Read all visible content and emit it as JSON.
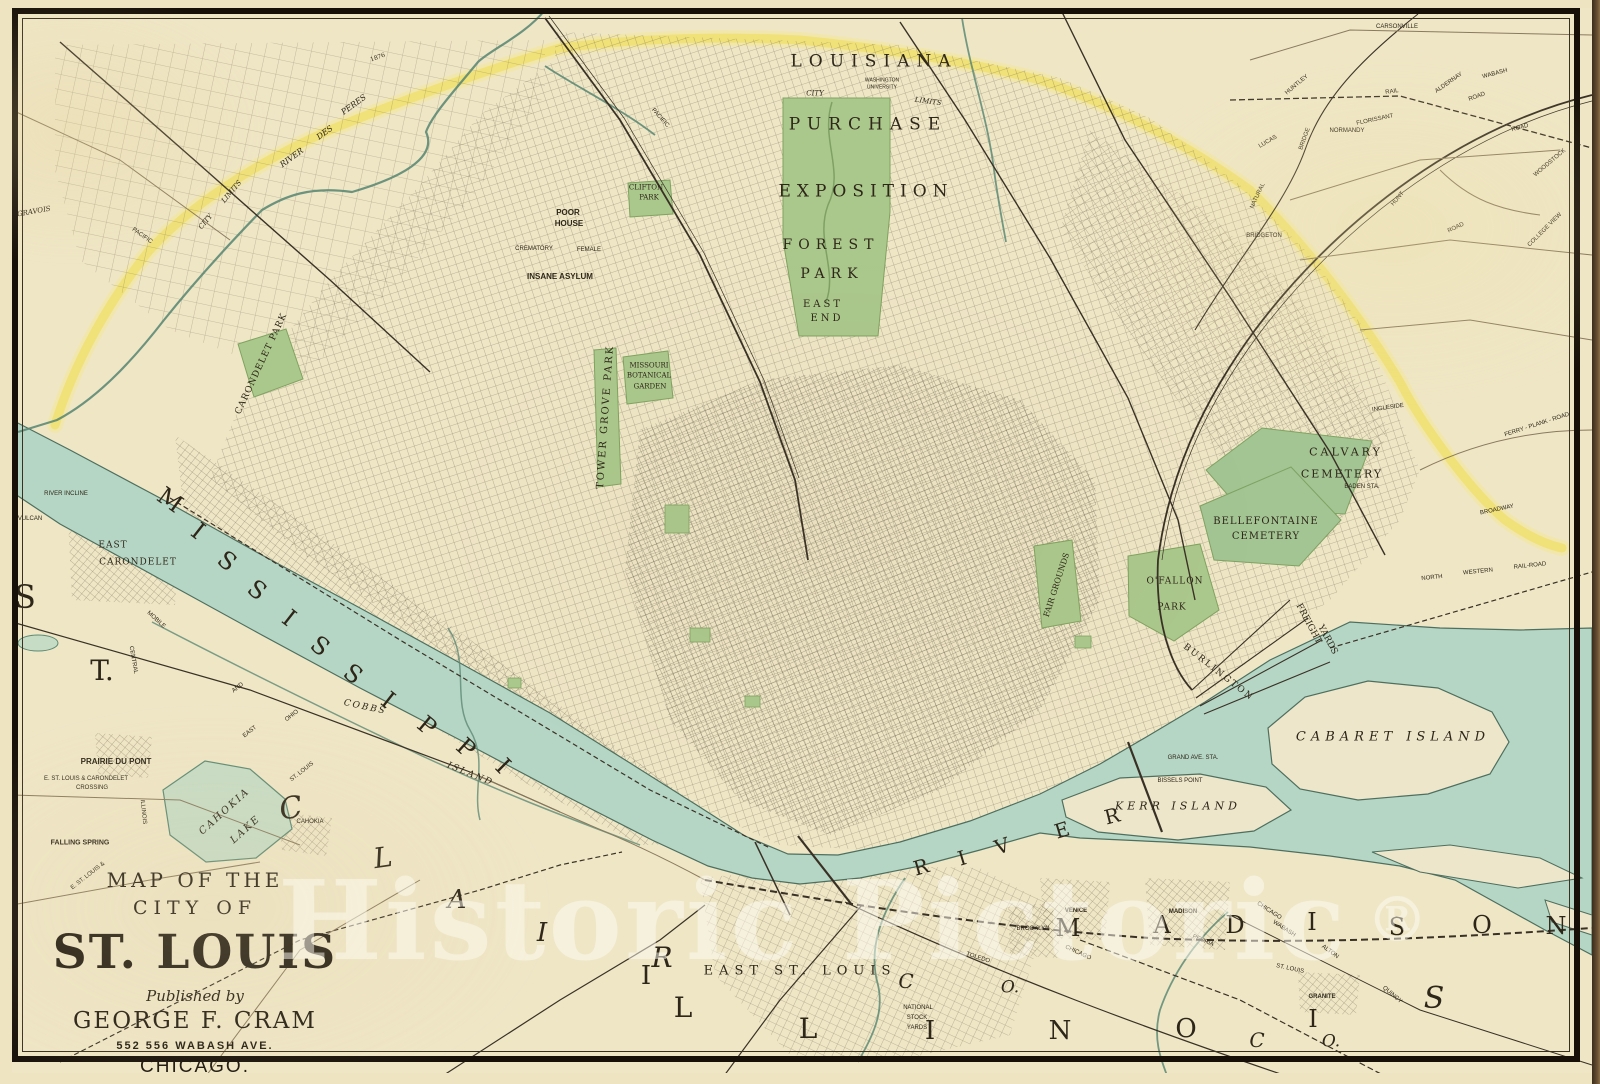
{
  "watermark": {
    "text": "Historic Pictoric",
    "registered": "®"
  },
  "title_block": {
    "line1": "MAP OF THE",
    "line2": "CITY OF",
    "line3": "ST. LOUIS",
    "line4": "Published by",
    "line5": "GEORGE F. CRAM",
    "line6": "552  556  WABASH AVE.",
    "line7": "CHICAGO."
  },
  "colors": {
    "paper": "#efe6c6",
    "water": "#b6d6c5",
    "water_edge": "#4d6f5f",
    "park_green": "#abc88c",
    "city_limit_yellow": "#f0e06b",
    "ink": "#2e2619",
    "frame": "#171009"
  },
  "labels": [
    {
      "t": "LOUISIANA",
      "x": 874,
      "y": 62,
      "s": 17,
      "ls": 7,
      "n": "label-louisiana"
    },
    {
      "t": "PURCHASE",
      "x": 868,
      "y": 125,
      "s": 17,
      "ls": 7,
      "n": "label-purchase"
    },
    {
      "t": "EXPOSITION",
      "x": 866,
      "y": 192,
      "s": 17,
      "ls": 6,
      "n": "label-exposition"
    },
    {
      "t": "FOREST",
      "x": 831,
      "y": 245,
      "s": 14,
      "ls": 6,
      "n": "label-forest-park"
    },
    {
      "t": "PARK",
      "x": 832,
      "y": 274,
      "s": 14,
      "ls": 6
    },
    {
      "t": "EAST",
      "x": 823,
      "y": 305,
      "s": 10,
      "ls": 3
    },
    {
      "t": "END",
      "x": 827,
      "y": 319,
      "s": 10,
      "ls": 3
    },
    {
      "t": "WASHINGTON",
      "x": 882,
      "y": 81,
      "s": 5,
      "f": "sans"
    },
    {
      "t": "UNIVERSITY",
      "x": 882,
      "y": 88,
      "s": 5,
      "f": "sans"
    },
    {
      "t": "CITY",
      "x": 815,
      "y": 94,
      "s": 7,
      "it": 1
    },
    {
      "t": "LIMITS",
      "x": 928,
      "y": 102,
      "s": 7,
      "it": 1,
      "r": 8
    },
    {
      "t": "CITY",
      "x": 206,
      "y": 222,
      "s": 7,
      "it": 1,
      "r": -50
    },
    {
      "t": "LIMITS",
      "x": 232,
      "y": 192,
      "s": 7,
      "it": 1,
      "r": -50
    },
    {
      "t": "1876",
      "x": 378,
      "y": 58,
      "s": 6,
      "r": -20
    },
    {
      "t": "RIVER",
      "x": 292,
      "y": 158,
      "s": 8,
      "it": 1,
      "r": -36
    },
    {
      "t": "DES",
      "x": 325,
      "y": 133,
      "s": 8,
      "it": 1,
      "r": -36
    },
    {
      "t": "PERES",
      "x": 354,
      "y": 105,
      "s": 8,
      "it": 1,
      "r": -36
    },
    {
      "t": "CLIFTON",
      "x": 646,
      "y": 188,
      "s": 7
    },
    {
      "t": "PARK",
      "x": 649,
      "y": 198,
      "s": 7
    },
    {
      "t": "POOR",
      "x": 568,
      "y": 213,
      "s": 8,
      "f": "sans",
      "b": 1
    },
    {
      "t": "HOUSE",
      "x": 569,
      "y": 224,
      "s": 8,
      "f": "sans",
      "b": 1
    },
    {
      "t": "CREMATORY",
      "x": 534,
      "y": 249,
      "s": 6,
      "f": "sans"
    },
    {
      "t": "FEMALE",
      "x": 589,
      "y": 250,
      "s": 6,
      "f": "sans"
    },
    {
      "t": "INSANE ASYLUM",
      "x": 560,
      "y": 277,
      "s": 8,
      "f": "sans",
      "b": 1,
      "n": "label-insane-asylum"
    },
    {
      "t": "CARONDELET PARK",
      "x": 262,
      "y": 364,
      "s": 9,
      "r": -65,
      "ls": 1,
      "n": "label-carondelet-park"
    },
    {
      "t": "TOWER GROVE PARK",
      "x": 606,
      "y": 417,
      "s": 10,
      "r": -86,
      "ls": 2,
      "n": "label-tower-grove-park"
    },
    {
      "t": "MISSOURI",
      "x": 649,
      "y": 366,
      "s": 7
    },
    {
      "t": "BOTANICAL",
      "x": 649,
      "y": 376,
      "s": 7
    },
    {
      "t": "GARDEN",
      "x": 650,
      "y": 387,
      "s": 7
    },
    {
      "t": "FAIR GROUNDS",
      "x": 1057,
      "y": 585,
      "s": 8,
      "r": -72,
      "n": "label-fair-grounds"
    },
    {
      "t": "O'FALLON",
      "x": 1175,
      "y": 582,
      "s": 9,
      "ls": 1,
      "n": "label-ofallon-park"
    },
    {
      "t": "PARK",
      "x": 1172,
      "y": 608,
      "s": 9,
      "ls": 1
    },
    {
      "t": "CALVARY",
      "x": 1346,
      "y": 452,
      "s": 11,
      "ls": 3,
      "n": "label-calvary-cemetery"
    },
    {
      "t": "CEMETERY",
      "x": 1342,
      "y": 474,
      "s": 11,
      "ls": 2
    },
    {
      "t": "BELLEFONTAINE",
      "x": 1266,
      "y": 522,
      "s": 10,
      "ls": 1,
      "n": "label-bellefontaine-cemetery"
    },
    {
      "t": "CEMETERY",
      "x": 1266,
      "y": 537,
      "s": 10,
      "ls": 1
    },
    {
      "t": "BURLINGTON",
      "x": 1218,
      "y": 673,
      "s": 9,
      "r": 38,
      "ls": 2
    },
    {
      "t": "FREIGHT",
      "x": 1308,
      "y": 624,
      "s": 9,
      "r": 62
    },
    {
      "t": "YARDS",
      "x": 1327,
      "y": 640,
      "s": 9,
      "r": 62
    },
    {
      "t": "GRAND AVE. STA.",
      "x": 1193,
      "y": 758,
      "s": 6,
      "f": "sans"
    },
    {
      "t": "BISSELS POINT",
      "x": 1180,
      "y": 781,
      "s": 6,
      "f": "sans"
    },
    {
      "t": "BADEN STA.",
      "x": 1362,
      "y": 487,
      "s": 6,
      "f": "sans"
    },
    {
      "t": "INGLESIDE",
      "x": 1388,
      "y": 408,
      "s": 6,
      "f": "sans",
      "r": -8
    },
    {
      "t": "NORTH",
      "x": 1432,
      "y": 578,
      "s": 6,
      "f": "sans",
      "r": -6
    },
    {
      "t": "WESTERN",
      "x": 1478,
      "y": 572,
      "s": 6,
      "f": "sans",
      "r": -6
    },
    {
      "t": "RAIL-ROAD",
      "x": 1530,
      "y": 566,
      "s": 6,
      "f": "sans",
      "r": -6
    },
    {
      "t": "BROADWAY",
      "x": 1497,
      "y": 510,
      "s": 6,
      "f": "sans",
      "r": -12
    },
    {
      "t": "FERRY - PLANK - ROAD",
      "x": 1537,
      "y": 425,
      "s": 6,
      "f": "sans",
      "r": -18
    },
    {
      "t": "RIVER INCLINE",
      "x": 66,
      "y": 494,
      "s": 6,
      "f": "sans"
    },
    {
      "t": "VULCAN",
      "x": 30,
      "y": 519,
      "s": 6,
      "f": "sans"
    },
    {
      "t": "EAST",
      "x": 113,
      "y": 546,
      "s": 9,
      "ls": 1
    },
    {
      "t": "CARONDELET",
      "x": 138,
      "y": 563,
      "s": 9,
      "ls": 1
    },
    {
      "t": "MOBILE",
      "x": 156,
      "y": 620,
      "s": 6,
      "f": "sans",
      "r": 42
    },
    {
      "t": "CENTRAL",
      "x": 133,
      "y": 660,
      "s": 6,
      "f": "sans",
      "r": 80
    },
    {
      "t": "ILLINOIS",
      "x": 143,
      "y": 812,
      "s": 6,
      "f": "sans",
      "r": 84
    },
    {
      "t": "E. ST. LOUIS &",
      "x": 88,
      "y": 876,
      "s": 6,
      "f": "sans",
      "r": -38
    },
    {
      "t": "AND",
      "x": 238,
      "y": 688,
      "s": 6,
      "f": "sans",
      "r": -38
    },
    {
      "t": "OHIO",
      "x": 292,
      "y": 716,
      "s": 6,
      "f": "sans",
      "r": -38
    },
    {
      "t": "EAST",
      "x": 250,
      "y": 732,
      "s": 6,
      "f": "sans",
      "r": -38
    },
    {
      "t": "ST. LOUIS",
      "x": 302,
      "y": 772,
      "s": 6,
      "f": "sans",
      "r": -38
    },
    {
      "t": "PRAIRIE DU PONT",
      "x": 116,
      "y": 762,
      "s": 8,
      "f": "sans",
      "b": 1
    },
    {
      "t": "E. ST. LOUIS & CARONDELET",
      "x": 86,
      "y": 779,
      "s": 6,
      "f": "sans"
    },
    {
      "t": "CROSSING",
      "x": 92,
      "y": 788,
      "s": 6,
      "f": "sans"
    },
    {
      "t": "FALLING SPRING",
      "x": 80,
      "y": 843,
      "s": 7,
      "f": "sans",
      "b": 1
    },
    {
      "t": "CAHOKIA",
      "x": 225,
      "y": 812,
      "s": 10,
      "it": 1,
      "r": -42,
      "ls": 2
    },
    {
      "t": "LAKE",
      "x": 246,
      "y": 830,
      "s": 10,
      "it": 1,
      "r": -42,
      "ls": 2
    },
    {
      "t": "CAHOKIA",
      "x": 310,
      "y": 822,
      "s": 6,
      "f": "sans"
    },
    {
      "t": "COBBS",
      "x": 365,
      "y": 708,
      "s": 9,
      "it": 1,
      "r": 12,
      "ls": 2
    },
    {
      "t": "ISLAND",
      "x": 470,
      "y": 775,
      "s": 9,
      "it": 1,
      "r": 22,
      "ls": 2
    },
    {
      "t": "CABARET  ISLAND",
      "x": 1393,
      "y": 737,
      "s": 13,
      "it": 1,
      "ls": 5,
      "n": "label-cabaret-island"
    },
    {
      "t": "KERR  ISLAND",
      "x": 1178,
      "y": 806,
      "s": 11,
      "it": 1,
      "ls": 4,
      "n": "label-kerr-island"
    },
    {
      "t": "VENICE",
      "x": 1076,
      "y": 911,
      "s": 6,
      "f": "sans",
      "b": 1
    },
    {
      "t": "BROOKLYN",
      "x": 1033,
      "y": 929,
      "s": 6,
      "f": "sans"
    },
    {
      "t": "MADISON",
      "x": 1183,
      "y": 912,
      "s": 6,
      "f": "sans",
      "b": 1
    },
    {
      "t": "GRANITE",
      "x": 1322,
      "y": 997,
      "s": 6,
      "f": "sans",
      "b": 1
    },
    {
      "t": "EAST ST. LOUIS",
      "x": 800,
      "y": 971,
      "s": 13,
      "ls": 6,
      "n": "label-east-st-louis"
    },
    {
      "t": "NATIONAL",
      "x": 918,
      "y": 1008,
      "s": 6,
      "f": "sans"
    },
    {
      "t": "STOCK",
      "x": 917,
      "y": 1018,
      "s": 6,
      "f": "sans"
    },
    {
      "t": "YARDS",
      "x": 917,
      "y": 1028,
      "s": 6,
      "f": "sans"
    },
    {
      "t": "ST. LOUIS",
      "x": 1290,
      "y": 969,
      "s": 6,
      "f": "sans",
      "r": 12
    },
    {
      "t": "PEORIA",
      "x": 1203,
      "y": 941,
      "s": 6,
      "f": "sans",
      "r": 22
    },
    {
      "t": "CHICAGO",
      "x": 1269,
      "y": 911,
      "s": 6,
      "f": "sans",
      "r": 33
    },
    {
      "t": "WABASH",
      "x": 1284,
      "y": 929,
      "s": 6,
      "f": "sans",
      "r": 33
    },
    {
      "t": "ALTON",
      "x": 1330,
      "y": 952,
      "s": 6,
      "f": "sans",
      "r": 36
    },
    {
      "t": "QUINCY",
      "x": 1392,
      "y": 995,
      "s": 6,
      "f": "sans",
      "r": 40
    },
    {
      "t": "TOLEDO",
      "x": 978,
      "y": 958,
      "s": 6,
      "f": "sans",
      "r": 18
    },
    {
      "t": "CHICAGO",
      "x": 1078,
      "y": 953,
      "s": 6,
      "f": "sans",
      "r": 25
    },
    {
      "t": "GRAVOIS",
      "x": 34,
      "y": 212,
      "s": 7,
      "it": 1,
      "r": -10
    },
    {
      "t": "PACIFIC",
      "x": 660,
      "y": 118,
      "s": 6,
      "f": "sans",
      "r": 48
    },
    {
      "t": "PACIFIC",
      "x": 142,
      "y": 236,
      "s": 6,
      "f": "sans",
      "r": 35
    },
    {
      "t": "CARSONVILLE",
      "x": 1397,
      "y": 27,
      "s": 6,
      "f": "sans"
    },
    {
      "t": "HUNTLEY",
      "x": 1297,
      "y": 85,
      "s": 6,
      "f": "sans",
      "r": -40
    },
    {
      "t": "RAIL",
      "x": 1392,
      "y": 92,
      "s": 6,
      "f": "sans",
      "r": -8
    },
    {
      "t": "ALDERNAY",
      "x": 1449,
      "y": 83,
      "s": 6,
      "f": "sans",
      "r": -35
    },
    {
      "t": "ROAD",
      "x": 1477,
      "y": 97,
      "s": 6,
      "f": "sans",
      "r": -20
    },
    {
      "t": "WABASH",
      "x": 1495,
      "y": 74,
      "s": 6,
      "f": "sans",
      "r": -15
    },
    {
      "t": "FLORISSANT",
      "x": 1375,
      "y": 120,
      "s": 6,
      "f": "sans",
      "r": -12
    },
    {
      "t": "NORMANDY",
      "x": 1347,
      "y": 131,
      "s": 6,
      "f": "sans"
    },
    {
      "t": "BRIDGE",
      "x": 1305,
      "y": 139,
      "s": 6,
      "f": "sans",
      "r": -70
    },
    {
      "t": "LUCAS",
      "x": 1268,
      "y": 142,
      "s": 6,
      "f": "sans",
      "r": -30
    },
    {
      "t": "ROAD",
      "x": 1520,
      "y": 128,
      "s": 6,
      "f": "sans",
      "r": -15
    },
    {
      "t": "WOODSTOCK",
      "x": 1550,
      "y": 163,
      "s": 6,
      "f": "sans",
      "r": -40
    },
    {
      "t": "NATURAL",
      "x": 1258,
      "y": 196,
      "s": 6,
      "f": "sans",
      "r": -65
    },
    {
      "t": "HUNT",
      "x": 1398,
      "y": 199,
      "s": 6,
      "f": "sans",
      "r": -50
    },
    {
      "t": "ROAD",
      "x": 1456,
      "y": 228,
      "s": 6,
      "f": "sans",
      "r": -25
    },
    {
      "t": "COLLEGE VIEW",
      "x": 1545,
      "y": 230,
      "s": 6,
      "f": "sans",
      "r": -45
    },
    {
      "t": "BRIDGETON",
      "x": 1264,
      "y": 236,
      "s": 6,
      "f": "sans"
    },
    {
      "t": "M",
      "x": 170,
      "y": 500,
      "s": 24,
      "r": 36,
      "n": "letter-mississippi"
    },
    {
      "t": "I",
      "x": 198,
      "y": 531,
      "s": 24,
      "r": 38
    },
    {
      "t": "S",
      "x": 227,
      "y": 561,
      "s": 24,
      "r": 38
    },
    {
      "t": "S",
      "x": 257,
      "y": 590,
      "s": 24,
      "r": 38
    },
    {
      "t": "I",
      "x": 289,
      "y": 618,
      "s": 24,
      "r": 38
    },
    {
      "t": "S",
      "x": 320,
      "y": 646,
      "s": 24,
      "r": 38
    },
    {
      "t": "S",
      "x": 353,
      "y": 674,
      "s": 24,
      "r": 38
    },
    {
      "t": "I",
      "x": 388,
      "y": 700,
      "s": 24,
      "r": 38
    },
    {
      "t": "P",
      "x": 427,
      "y": 726,
      "s": 24,
      "r": 40
    },
    {
      "t": "P",
      "x": 466,
      "y": 748,
      "s": 24,
      "r": 42
    },
    {
      "t": "I",
      "x": 503,
      "y": 766,
      "s": 24,
      "r": 45
    },
    {
      "t": "R",
      "x": 921,
      "y": 867,
      "s": 20,
      "r": -16,
      "n": "letter-river"
    },
    {
      "t": "I",
      "x": 962,
      "y": 858,
      "s": 20,
      "r": -17
    },
    {
      "t": "V",
      "x": 1002,
      "y": 846,
      "s": 20,
      "r": -18
    },
    {
      "t": "E",
      "x": 1062,
      "y": 830,
      "s": 20,
      "r": -17
    },
    {
      "t": "R",
      "x": 1112,
      "y": 816,
      "s": 20,
      "r": -14
    },
    {
      "t": "S",
      "x": 25,
      "y": 597,
      "s": 32,
      "n": "letter-st-clair"
    },
    {
      "t": "T.",
      "x": 102,
      "y": 671,
      "s": 28
    },
    {
      "t": "C",
      "x": 291,
      "y": 809,
      "s": 30,
      "it": 1,
      "r": -10
    },
    {
      "t": "L",
      "x": 383,
      "y": 858,
      "s": 28,
      "it": 1,
      "r": -8
    },
    {
      "t": "A",
      "x": 457,
      "y": 900,
      "s": 26,
      "it": 1
    },
    {
      "t": "I",
      "x": 542,
      "y": 933,
      "s": 26,
      "it": 1
    },
    {
      "t": "R",
      "x": 662,
      "y": 958,
      "s": 28,
      "it": 1
    },
    {
      "t": "M",
      "x": 1068,
      "y": 928,
      "s": 24,
      "n": "letter-madison"
    },
    {
      "t": "A",
      "x": 1162,
      "y": 925,
      "s": 24
    },
    {
      "t": "D",
      "x": 1235,
      "y": 925,
      "s": 24
    },
    {
      "t": "I",
      "x": 1312,
      "y": 922,
      "s": 24
    },
    {
      "t": "S",
      "x": 1397,
      "y": 927,
      "s": 24
    },
    {
      "t": "O",
      "x": 1482,
      "y": 925,
      "s": 24
    },
    {
      "t": "N",
      "x": 1556,
      "y": 926,
      "s": 24
    },
    {
      "t": "I",
      "x": 646,
      "y": 976,
      "s": 26,
      "n": "letter-illinois"
    },
    {
      "t": "L",
      "x": 683,
      "y": 1008,
      "s": 28
    },
    {
      "t": "L",
      "x": 808,
      "y": 1029,
      "s": 28
    },
    {
      "t": "I",
      "x": 930,
      "y": 1031,
      "s": 26
    },
    {
      "t": "N",
      "x": 1060,
      "y": 1031,
      "s": 26
    },
    {
      "t": "O",
      "x": 1186,
      "y": 1029,
      "s": 26
    },
    {
      "t": "I",
      "x": 1313,
      "y": 1019,
      "s": 24
    },
    {
      "t": "S",
      "x": 1434,
      "y": 999,
      "s": 30,
      "it": 1
    },
    {
      "t": "C",
      "x": 906,
      "y": 981,
      "s": 20,
      "it": 1
    },
    {
      "t": "O.",
      "x": 1010,
      "y": 988,
      "s": 17,
      "it": 1
    },
    {
      "t": "C",
      "x": 1257,
      "y": 1040,
      "s": 20,
      "it": 1
    },
    {
      "t": "O.",
      "x": 1331,
      "y": 1042,
      "s": 17,
      "it": 1
    }
  ]
}
